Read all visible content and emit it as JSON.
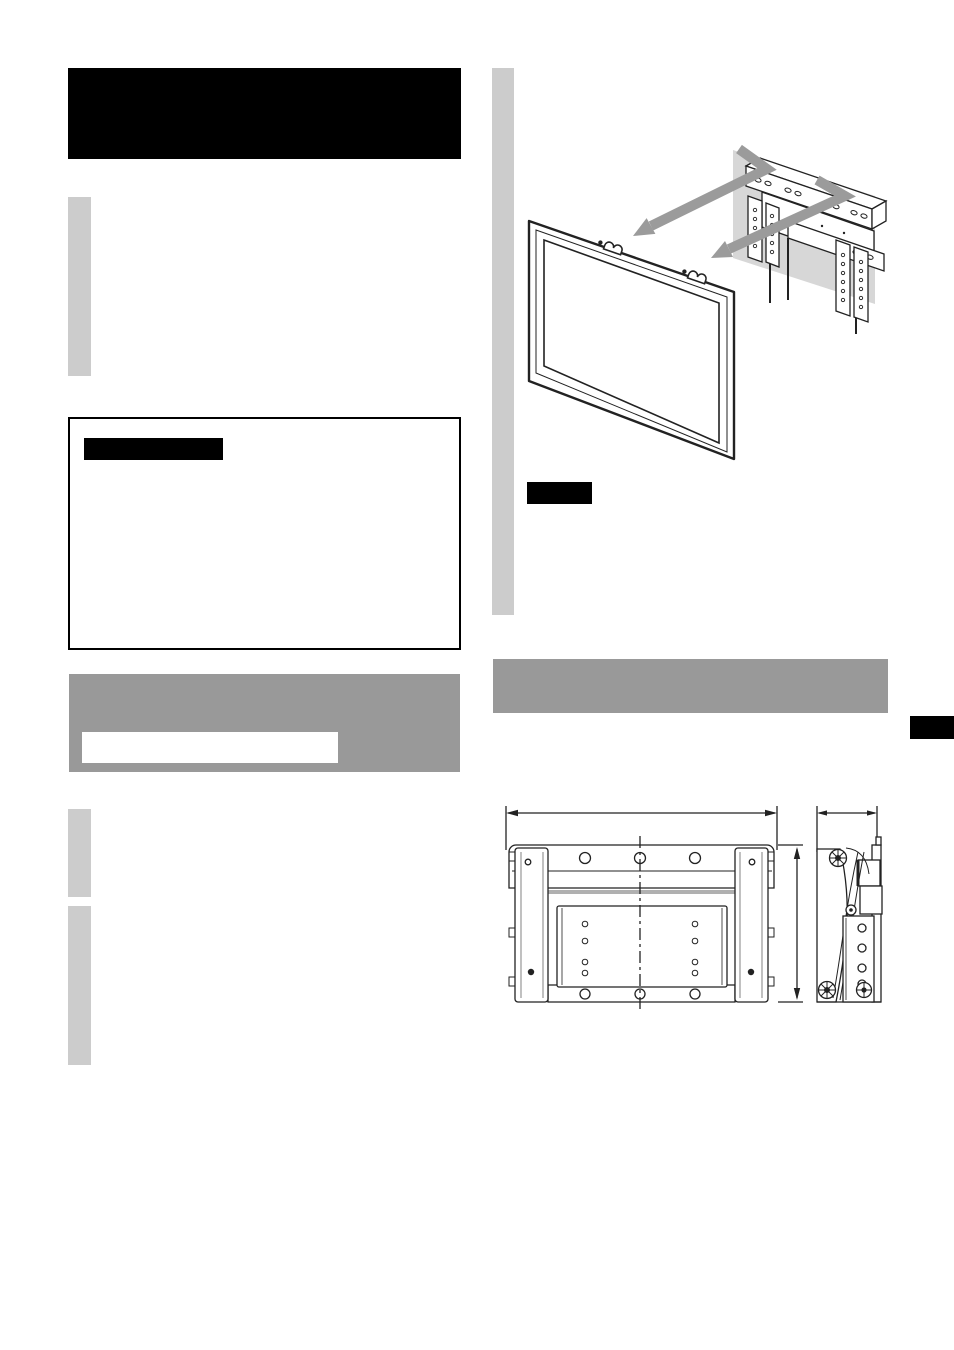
{
  "page": {
    "kind": "instruction-manual-page",
    "background": "#ffffff",
    "width_px": 954,
    "height_px": 1350
  },
  "palette": {
    "redaction_black": "#000000",
    "banner_gray": "#999999",
    "placeholder_bar_gray": "#cccccc",
    "wall_patch_gray": "#d7d7d7",
    "arrow_gray": "#9b9b9b",
    "line_art": "#222222",
    "soft_rule_gray": "#b0b0b0"
  },
  "left_column": {
    "title_block_text": "",
    "intro_bar_text": "",
    "warning_box": {
      "heading_text": "",
      "body_text": ""
    },
    "gray_banner": {
      "text": "",
      "inset_box_text": ""
    },
    "paragraph_bar_1_text": "",
    "paragraph_bar_2_text": ""
  },
  "right_column": {
    "column_bar_text": "",
    "figure_note_label_text": "",
    "section_banner_text": "",
    "page_edge_tab_text": ""
  },
  "figures": {
    "mounting_illustration": {
      "elements": [
        "tv-panel",
        "hanging-hooks",
        "wall-patch",
        "wall-mount-bracket",
        "alignment-arrows"
      ],
      "hook_count": 2,
      "arrow_count": 2
    },
    "dimension_diagram": {
      "views": [
        "front-view",
        "side-view"
      ],
      "dimension_lines": [
        "overall-width",
        "overall-height",
        "depth"
      ],
      "hole_rows_front_top": 3,
      "hole_rows_front_bottom": 3,
      "center_plate_hole_columns": 2
    }
  }
}
